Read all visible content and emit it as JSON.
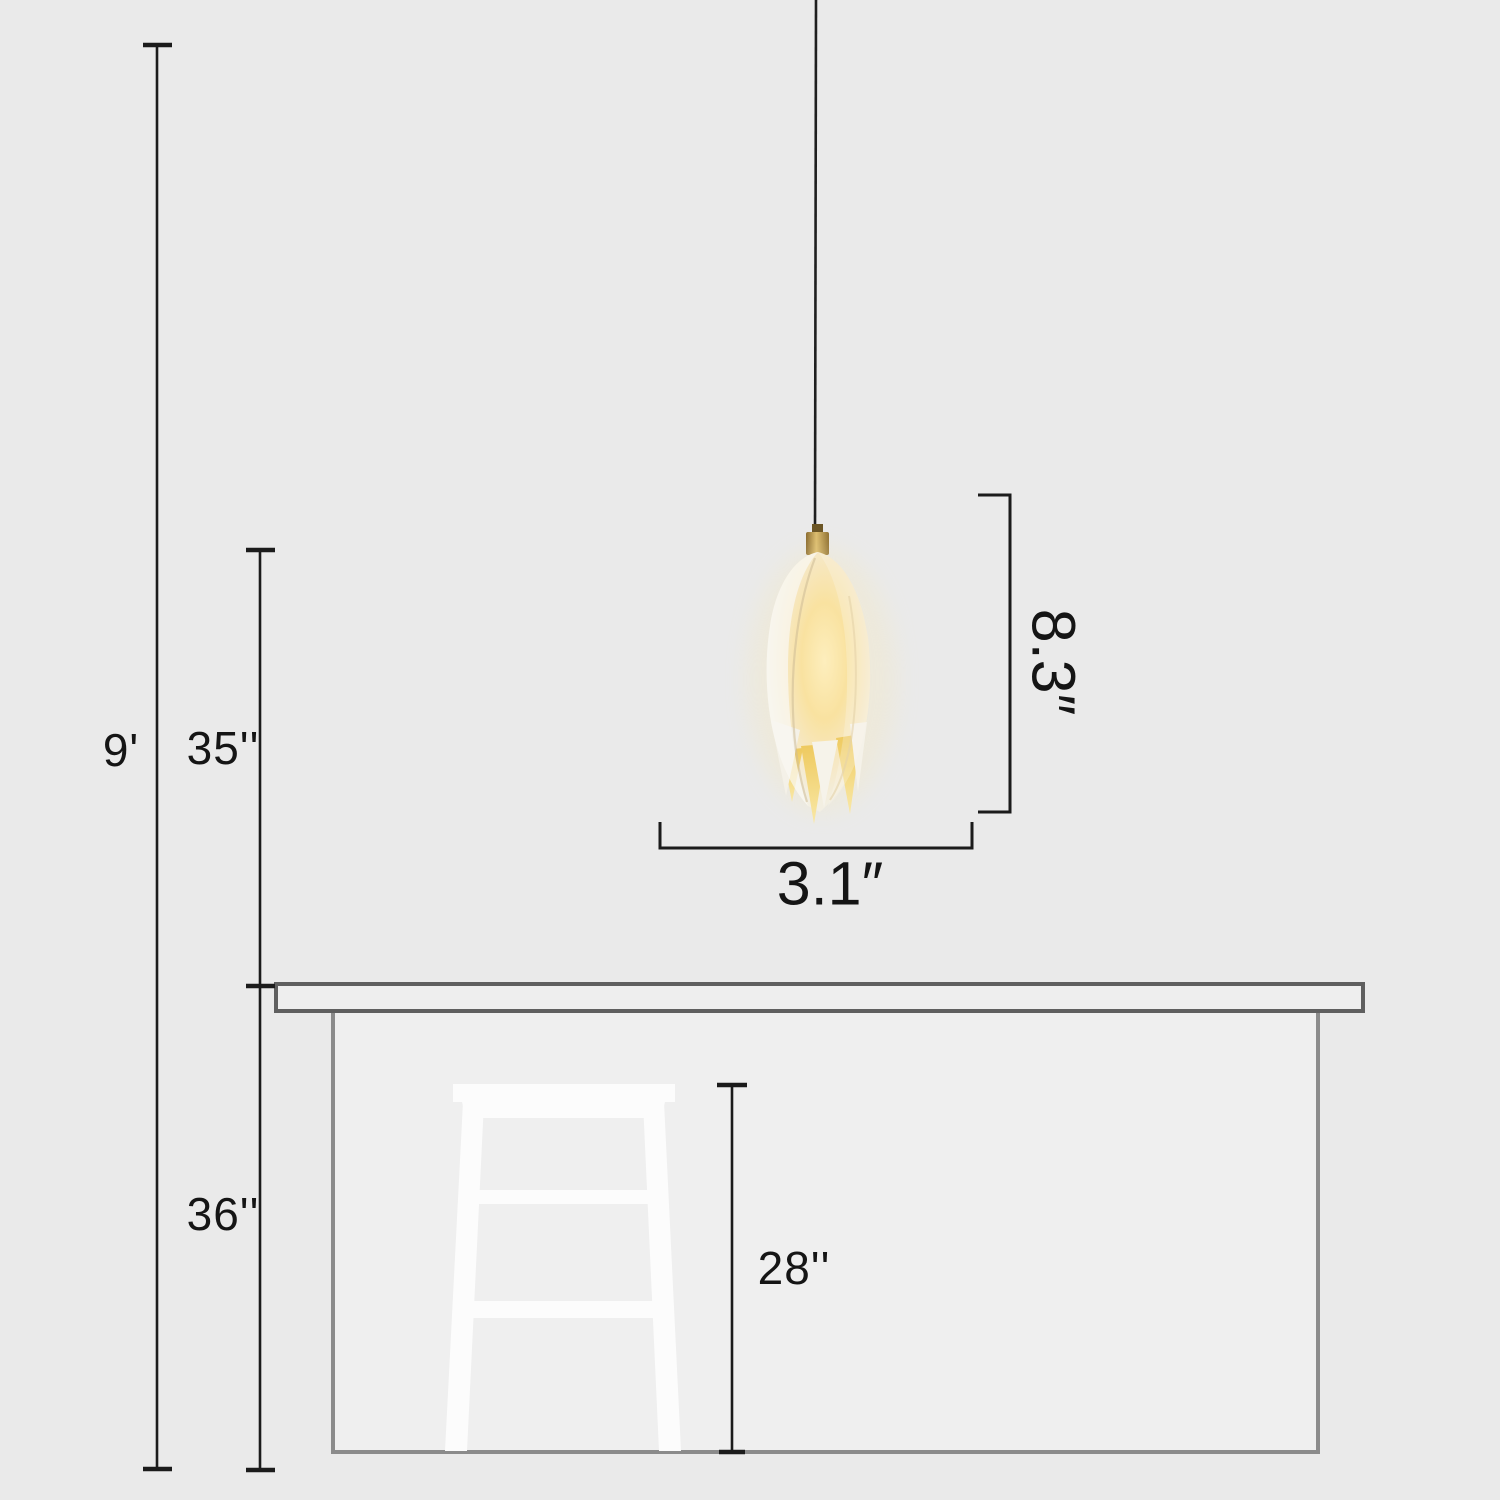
{
  "diagram": {
    "type": "product-dimension-diagram",
    "scene": {
      "fixture": "tulip-flower-pendant-light",
      "furniture": [
        "kitchen-counter",
        "bar-stool"
      ]
    },
    "labels": {
      "ceiling_height": "9'",
      "lamp_drop_above_counter": "35''",
      "counter_height": "36''",
      "stool_height": "28''",
      "shade_height": "8.3″",
      "shade_width": "3.1″"
    },
    "colors": {
      "background": "#eaeaea",
      "dimension_line": "#1b1b1b",
      "countertop_outline": "#5f5f5f",
      "counter_body_outline": "#8b8b8b",
      "counter_fill": "#efefef",
      "stool_fill": "#fcfcfc",
      "cord": "#1f1f1f",
      "cap_brass": "#b3914c",
      "glow_warm": "#f9e2a0",
      "shade_cream": "#f2f0e8"
    }
  }
}
